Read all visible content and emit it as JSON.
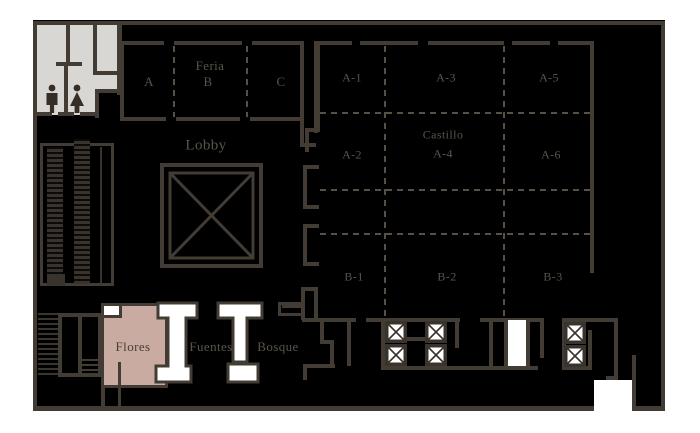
{
  "plan_title": "Convention center meeting-space floor plan",
  "colors": {
    "page_background": "#ffffff",
    "floor_fill": "#000000",
    "wall": "#423c34",
    "label_text": "#5a544b",
    "restroom_fill": "#d8d7d3",
    "highlight_room_fill": "#c9aba1",
    "feature_white": "#ffffff"
  },
  "rooms": {
    "feria": "Feria",
    "feria_a": "A",
    "feria_b": "B",
    "feria_c": "C",
    "lobby": "Lobby",
    "a1": "A-1",
    "a2": "A-2",
    "a3": "A-3",
    "castillo": "Castillo",
    "a4": "A-4",
    "a5": "A-5",
    "a6": "A-6",
    "b1": "B-1",
    "b2": "B-2",
    "b3": "B-3",
    "flores": "Flores",
    "fuentes": "Fuentes",
    "bosque": "Bosque"
  },
  "icons": {
    "mens_restroom": "man-pictogram",
    "womens_restroom": "woman-pictogram",
    "elevator": "boxed-x",
    "lobby_atrium": "double-square-x",
    "escalators": "hatched-strips",
    "stairs": "ladder-hatch"
  }
}
